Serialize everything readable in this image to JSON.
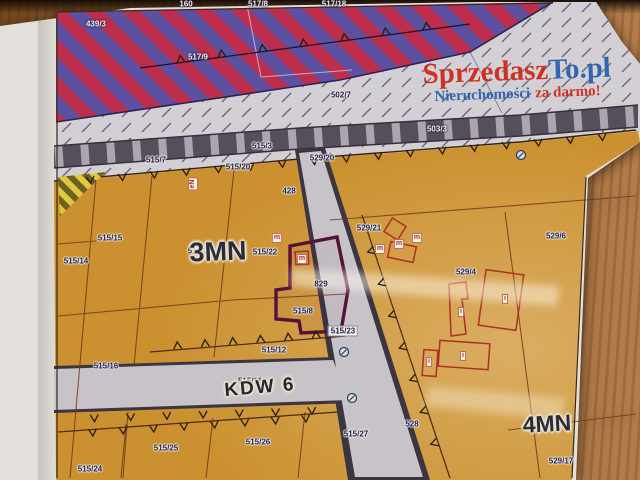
{
  "watermark": {
    "brand_primary": "Sprzedasz",
    "brand_secondary": "To.pl",
    "tagline_primary": "Nieruchomości",
    "tagline_secondary": "za darmo!"
  },
  "zones": {
    "zone_3mn": "3MN",
    "zone_4mn": "4MN",
    "road_kdw": "KDW 6"
  },
  "parcel_labels": [
    {
      "text": "160",
      "x": 186,
      "y": 4,
      "variant": "light"
    },
    {
      "text": "517/8",
      "x": 258,
      "y": 4,
      "variant": "light"
    },
    {
      "text": "517/18",
      "x": 334,
      "y": 4,
      "variant": "light"
    },
    {
      "text": "439/3",
      "x": 96,
      "y": 24,
      "variant": "light"
    },
    {
      "text": "517/9",
      "x": 198,
      "y": 57,
      "variant": "light"
    },
    {
      "text": "502/7",
      "x": 341,
      "y": 95
    },
    {
      "text": "503/3",
      "x": 437,
      "y": 129,
      "variant": "light"
    },
    {
      "text": "515/7",
      "x": 156,
      "y": 160
    },
    {
      "text": "515/3",
      "x": 262,
      "y": 146
    },
    {
      "text": "515/20",
      "x": 238,
      "y": 167
    },
    {
      "text": "529/20",
      "x": 322,
      "y": 158
    },
    {
      "text": "428",
      "x": 289,
      "y": 191
    },
    {
      "text": "515/15",
      "x": 110,
      "y": 238
    },
    {
      "text": "515/14",
      "x": 76,
      "y": 261
    },
    {
      "text": "515/21",
      "x": 200,
      "y": 251
    },
    {
      "text": "515/22",
      "x": 265,
      "y": 252
    },
    {
      "text": "529/21",
      "x": 369,
      "y": 228
    },
    {
      "text": "529/6",
      "x": 556,
      "y": 236
    },
    {
      "text": "529/4",
      "x": 466,
      "y": 272
    },
    {
      "text": "829",
      "x": 321,
      "y": 284
    },
    {
      "text": "515/8",
      "x": 303,
      "y": 311
    },
    {
      "text": "515/23",
      "x": 343,
      "y": 331,
      "variant": "chip"
    },
    {
      "text": "515/12",
      "x": 274,
      "y": 350
    },
    {
      "text": "515/16",
      "x": 106,
      "y": 366
    },
    {
      "text": "515/11",
      "x": 250,
      "y": 381
    },
    {
      "text": "515/25",
      "x": 166,
      "y": 448
    },
    {
      "text": "515/26",
      "x": 258,
      "y": 442
    },
    {
      "text": "515/27",
      "x": 356,
      "y": 434
    },
    {
      "text": "528",
      "x": 412,
      "y": 424
    },
    {
      "text": "515/24",
      "x": 90,
      "y": 469
    },
    {
      "text": "529/17",
      "x": 561,
      "y": 461
    }
  ],
  "building_labels": [
    {
      "text": "m",
      "x": 380,
      "y": 249
    },
    {
      "text": "m",
      "x": 399,
      "y": 244
    },
    {
      "text": "m",
      "x": 417,
      "y": 238
    },
    {
      "text": "m",
      "x": 277,
      "y": 238
    },
    {
      "text": "m",
      "x": 302,
      "y": 259
    },
    {
      "text": "i",
      "x": 505,
      "y": 299
    },
    {
      "text": "i",
      "x": 461,
      "y": 312
    },
    {
      "text": "i",
      "x": 463,
      "y": 356
    },
    {
      "text": "i",
      "x": 429,
      "y": 362
    },
    {
      "text": "eN",
      "x": 193,
      "y": 184,
      "rot": -90
    }
  ],
  "colors": {
    "stripe_red": "#bc2e4c",
    "stripe_purple": "#5e50a0",
    "zone_orange": "#cb9130",
    "road_dark": "#3a3541",
    "road_light": "#c7c3c9",
    "highlight_outline": "#551238",
    "building_outline": "#ad3026",
    "brand_red": "#cd2a1e",
    "brand_blue": "#2a62ae"
  }
}
